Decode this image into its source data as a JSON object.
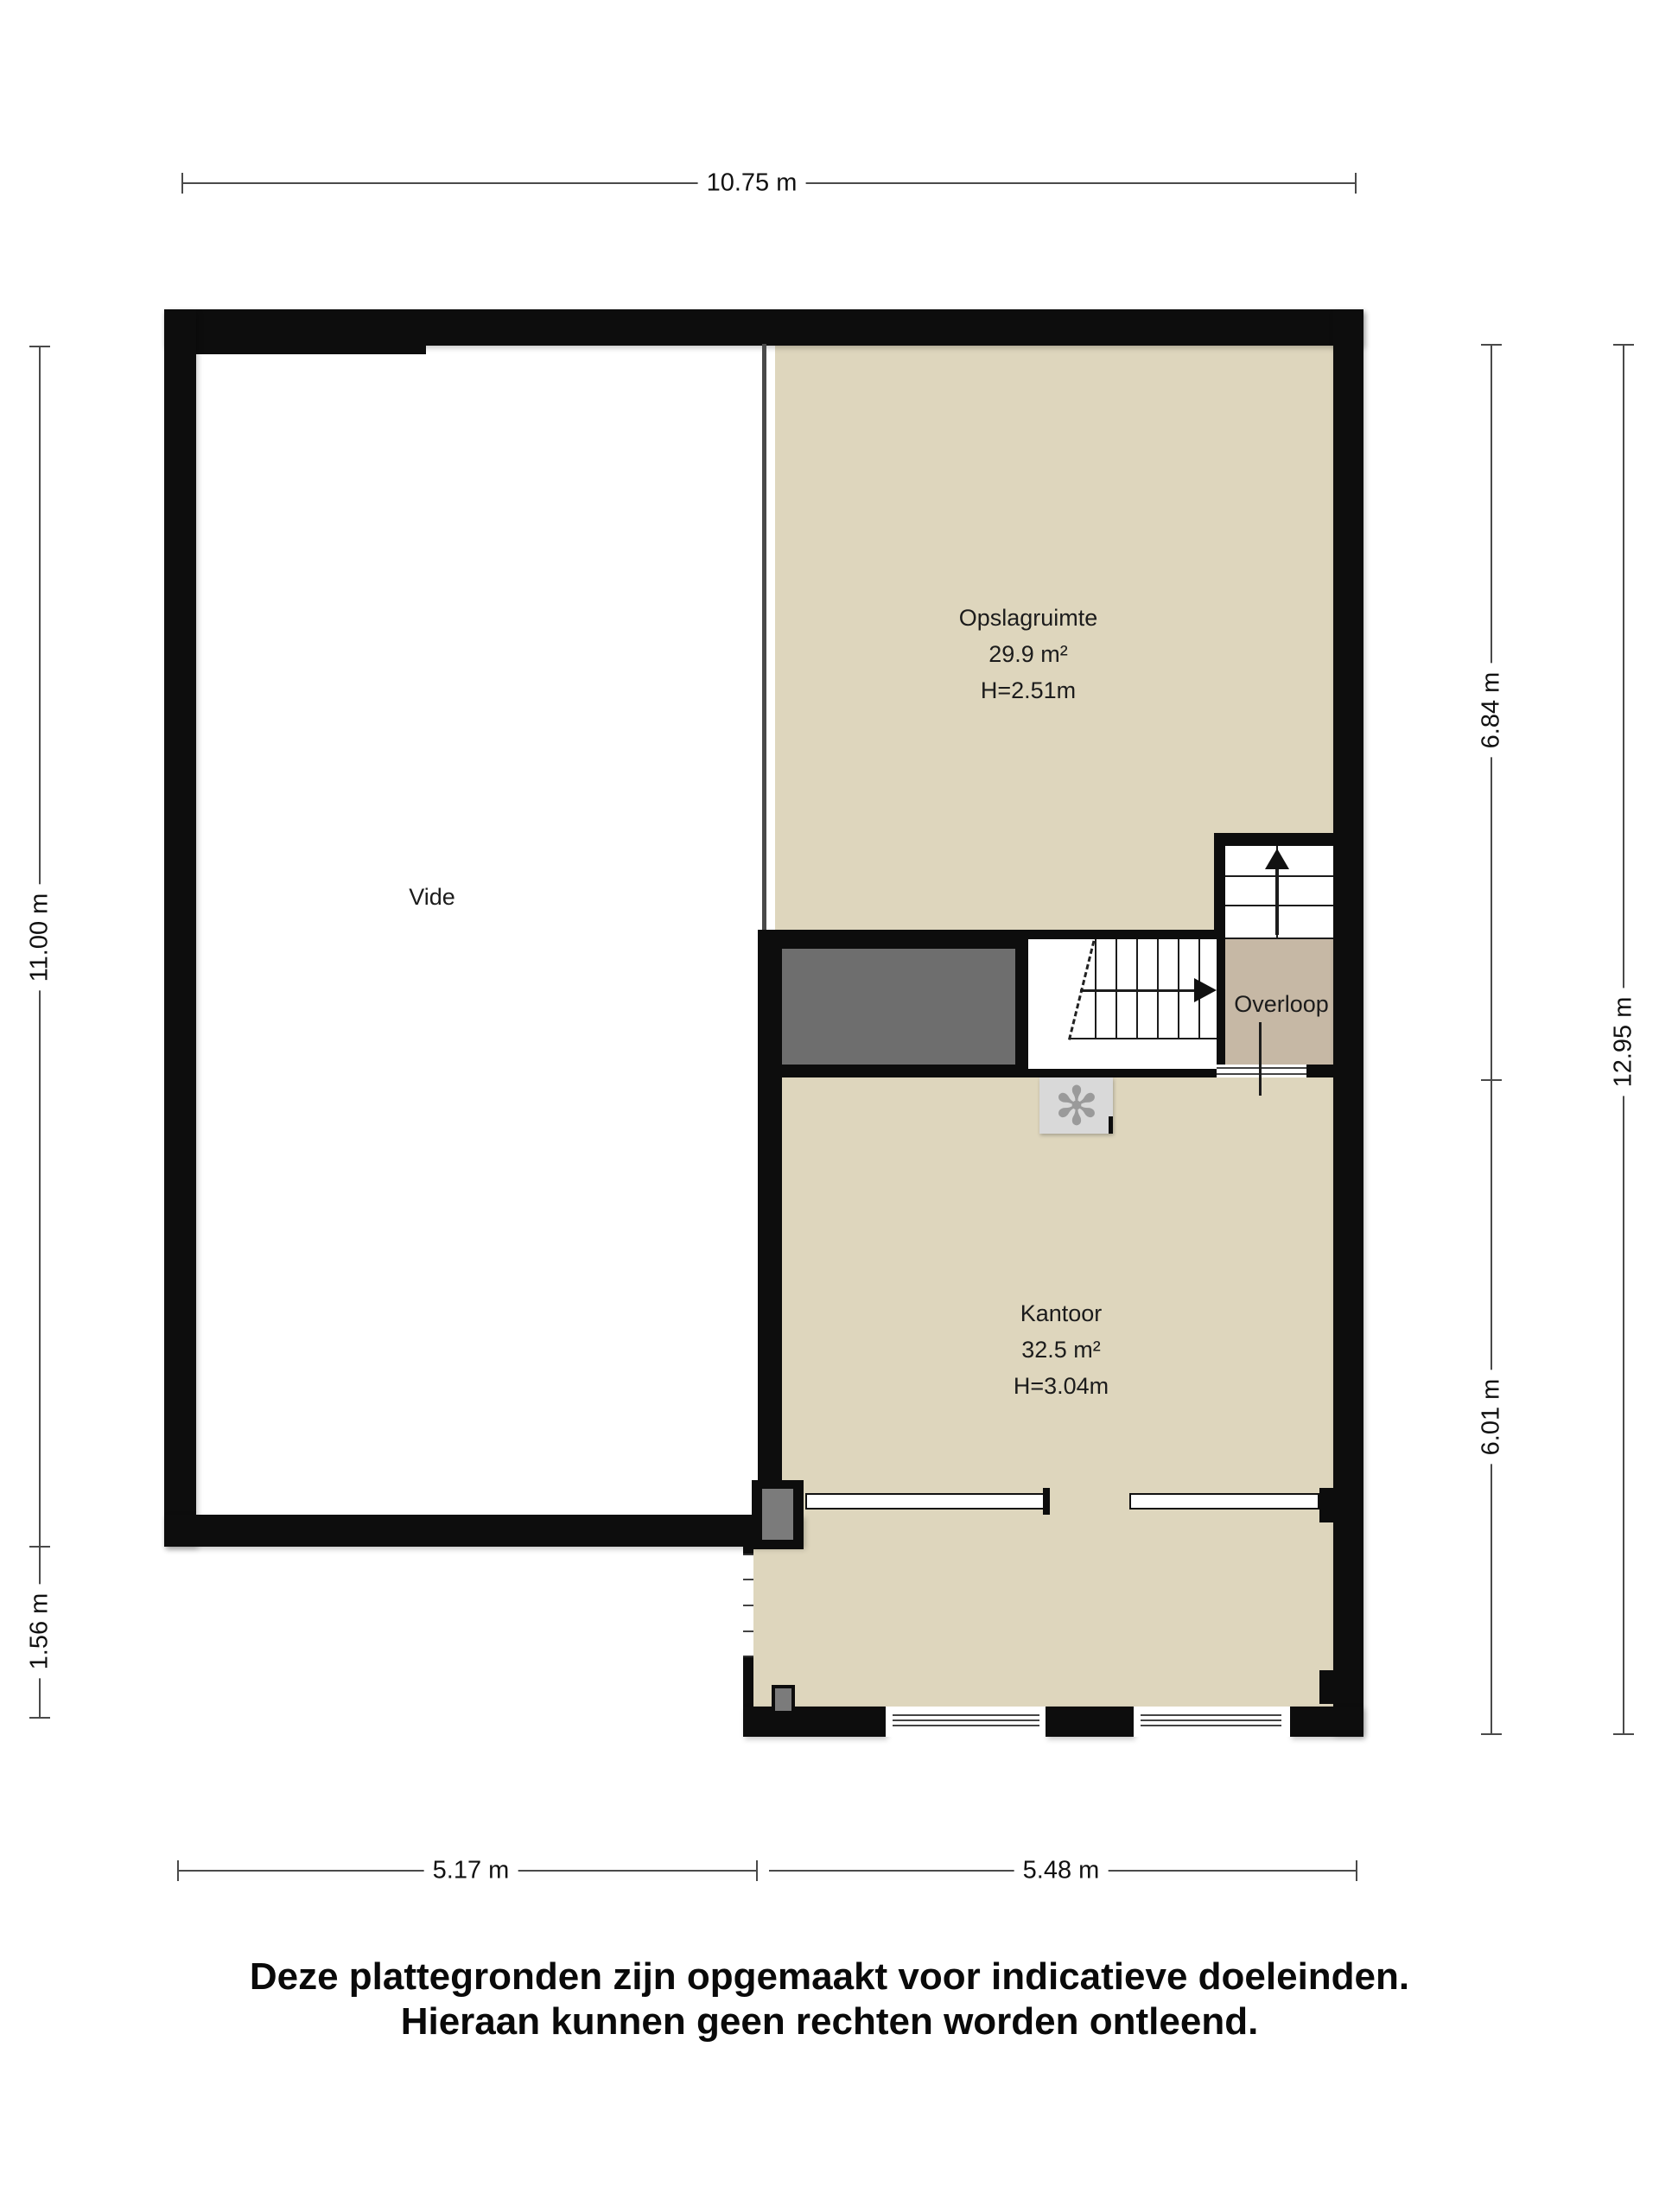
{
  "floorplan": {
    "rooms": {
      "vide": {
        "name": "Vide"
      },
      "opslagruimte": {
        "name": "Opslagruimte",
        "area": "29.9 m²",
        "height": "H=2.51m"
      },
      "overloop": {
        "name": "Overloop"
      },
      "kantoor": {
        "name": "Kantoor",
        "area": "32.5 m²",
        "height": "H=3.04m"
      }
    },
    "dimensions": {
      "top": "10.75 m",
      "left_upper": "11.00 m",
      "left_lower": "1.56 m",
      "right_inner_upper": "6.84 m",
      "right_inner_lower": "6.01 m",
      "right_outer": "12.95 m",
      "bottom_left": "5.17 m",
      "bottom_right": "5.48 m"
    },
    "icons": {
      "ventilation": "✻"
    },
    "colors": {
      "room_fill": "#ded6bd",
      "overloop_fill": "#c6b8a5",
      "void_fill": "#6e6e6e",
      "wall": "#0d0d0d",
      "vent_box": "#d9d9d9"
    },
    "disclaimer": {
      "line1": "Deze plattegronden zijn opgemaakt voor indicatieve doeleinden.",
      "line2": "Hieraan kunnen geen rechten worden ontleend."
    }
  }
}
